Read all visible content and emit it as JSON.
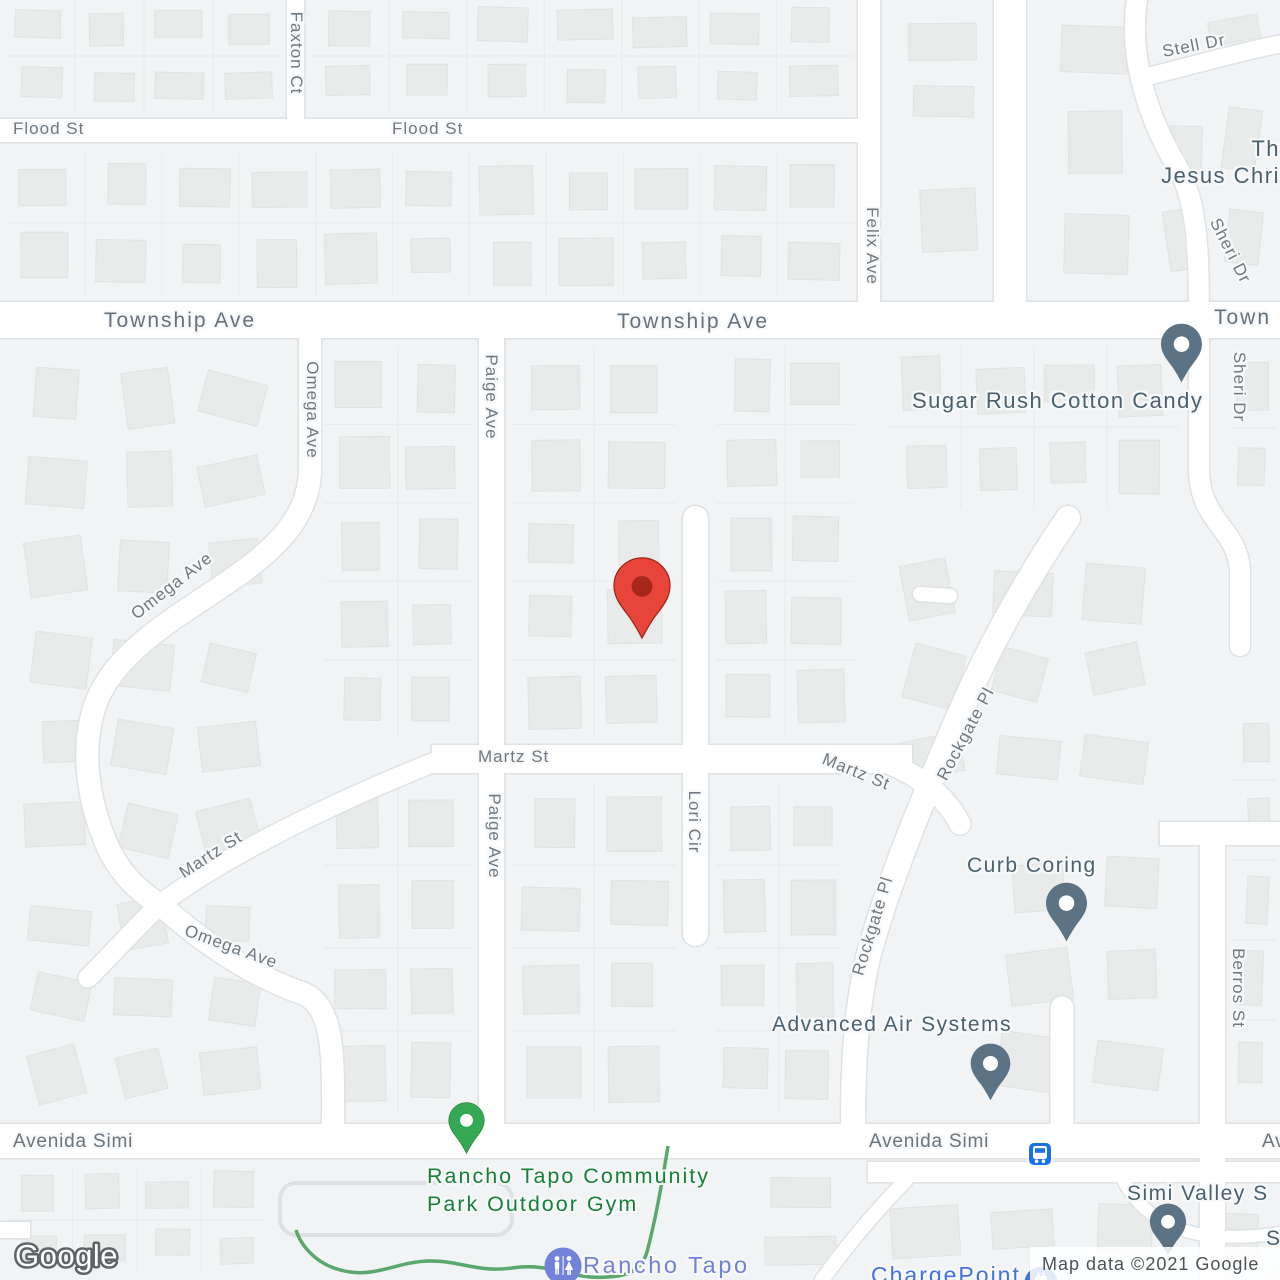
{
  "colors": {
    "map_background": "#f1f3f4",
    "road_fill": "#ffffff",
    "road_casing": "#dfe3e6",
    "building_fill": "#e9ebeb",
    "street_label_gray": "#70797f",
    "poi_label_slate": "#4a616e",
    "park_label_green": "#188038",
    "community_label_purple": "#7282d8",
    "ev_label_blue": "#4472dd",
    "destination_pin_red": "#e9443a",
    "destination_pin_inner": "#a8271b",
    "poi_pin_gray": "#5b7384",
    "park_pin_green": "#34a853",
    "bus_icon_blue": "#1a73e8",
    "trail_green": "#5aa86e"
  },
  "street_labels": [
    {
      "text": "Flood St"
    },
    {
      "text": "Flood St"
    },
    {
      "text": "Faxton Ct"
    },
    {
      "text": "Township Ave"
    },
    {
      "text": "Township Ave"
    },
    {
      "text": "Town"
    },
    {
      "text": "Felix Ave"
    },
    {
      "text": "Stell Dr"
    },
    {
      "text": "Sheri Dr"
    },
    {
      "text": "Sheri Dr"
    },
    {
      "text": "Omega Ave"
    },
    {
      "text": "Omega Ave"
    },
    {
      "text": "Martz St"
    },
    {
      "text": "Omega Ave"
    },
    {
      "text": "Paige Ave"
    },
    {
      "text": "Paige Ave"
    },
    {
      "text": "Martz St"
    },
    {
      "text": "Martz St"
    },
    {
      "text": "Lori Cir"
    },
    {
      "text": "Rockgate Pl"
    },
    {
      "text": "Rockgate Pl"
    },
    {
      "text": "Berros St"
    },
    {
      "text": "Avenida Simi"
    },
    {
      "text": "Avenida Simi"
    },
    {
      "text": "Av"
    }
  ],
  "pois": {
    "sugar_rush": {
      "name": "Sugar Rush Cotton Candy"
    },
    "curb_coring": {
      "name": "Curb Coring"
    },
    "advanced_air": {
      "name": "Advanced Air Systems"
    },
    "simi_valley": {
      "name": "Simi Valley S"
    },
    "si_partial": {
      "name": "Si"
    },
    "church": {
      "line1": "Th",
      "line2": "Jesus Chri"
    },
    "park": {
      "line1": "Rancho Tapo Community",
      "line2": "Park Outdoor Gym"
    },
    "rancho_tapo": {
      "name": "Rancho Tapo"
    },
    "chargepoint": {
      "name": "ChargePoint"
    }
  },
  "markers": {
    "destination": {
      "color": "#e9443a"
    },
    "sugar_rush": {
      "color": "#5b7384"
    },
    "curb_coring": {
      "color": "#5b7384"
    },
    "advanced_air": {
      "color": "#5b7384"
    },
    "simi_valley": {
      "color": "#5b7384"
    },
    "park": {
      "color": "#34a853"
    },
    "bus_stop": {
      "color": "#1a73e8"
    },
    "rancho_tapo_circle": {
      "color": "#7282d8"
    },
    "chargepoint_circle": {
      "color": "#4472dd"
    }
  },
  "attribution": {
    "text": "Map data ©2021 Google"
  },
  "watermark": {
    "text": "Google"
  }
}
